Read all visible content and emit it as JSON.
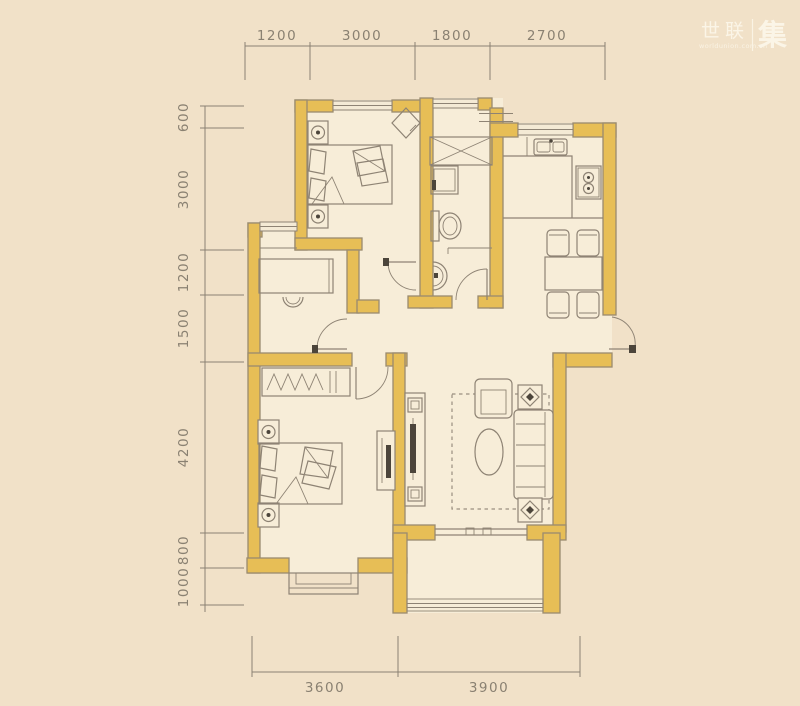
{
  "logo": {
    "brand": "世联",
    "tagline": "worldunion.com.cn",
    "seal": "集"
  },
  "dimensions": {
    "top": [
      {
        "label": "1200"
      },
      {
        "label": "3000"
      },
      {
        "label": "1800"
      },
      {
        "label": "2700"
      }
    ],
    "left": [
      {
        "label": "600"
      },
      {
        "label": "3000"
      },
      {
        "label": "1200"
      },
      {
        "label": "1500"
      },
      {
        "label": "4200"
      },
      {
        "label": "800"
      },
      {
        "label": "1000"
      }
    ],
    "bottom": [
      {
        "label": "3600"
      },
      {
        "label": "3900"
      }
    ]
  },
  "colors": {
    "background": "#F1E1C8",
    "floor": "#F7EDD8",
    "wall": "#E7BE56",
    "line": "#8E8374",
    "dimension": "#8B8173",
    "logo_text": "#FBF5E7"
  }
}
